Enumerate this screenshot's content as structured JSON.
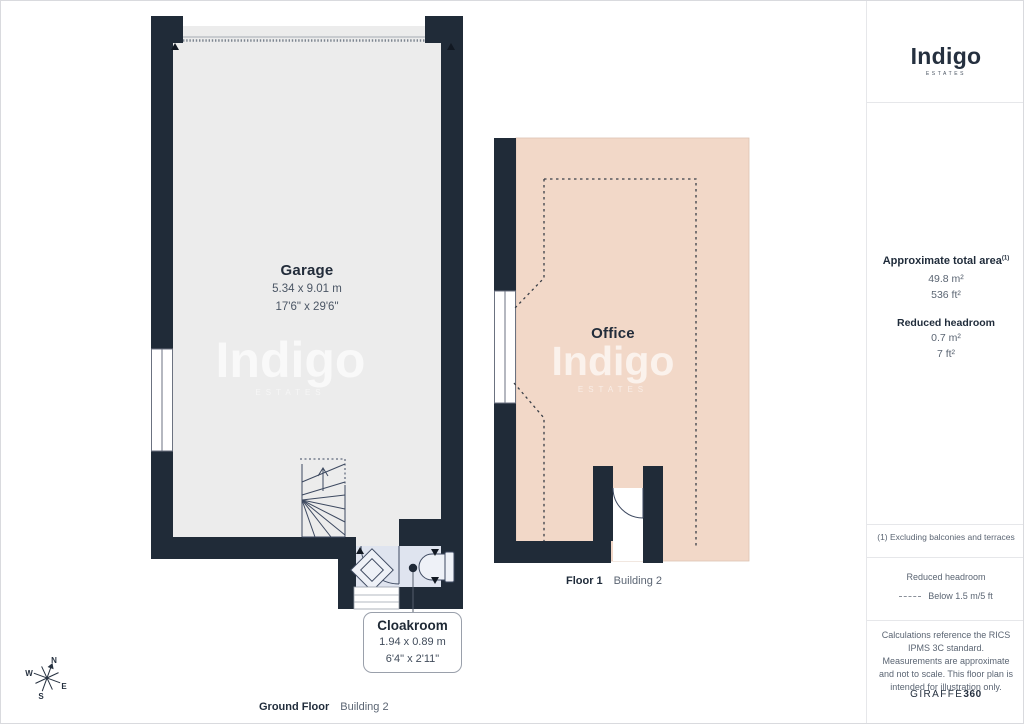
{
  "brand": {
    "logo": "Indigo",
    "logo_sub": "ESTATES"
  },
  "watermark": {
    "word": "Indigo",
    "sub": "ESTATES"
  },
  "plan": {
    "garage": {
      "name": "Garage",
      "metric": "5.34 x 9.01 m",
      "imperial": "17'6\" x 29'6\""
    },
    "office": {
      "name": "Office"
    },
    "cloakroom": {
      "name": "Cloakroom",
      "metric": "1.94 x 0.89 m",
      "imperial": "6'4\" x 2'11\""
    },
    "floor1_label": "Floor 1",
    "floor1_building": "Building 2",
    "ground_label": "Ground Floor",
    "ground_building": "Building 2",
    "compass": {
      "n": "N",
      "e": "E",
      "s": "S",
      "w": "W"
    }
  },
  "sidebar": {
    "area_title": "Approximate total area",
    "area_footnote_marker": "(1)",
    "area_m2": "49.8 m²",
    "area_ft2": "536 ft²",
    "reduced_title": "Reduced headroom",
    "reduced_m2": "0.7 m²",
    "reduced_ft2": "7 ft²",
    "footnote": "(1) Excluding balconies and terraces",
    "legend_title": "Reduced headroom",
    "legend_desc": "Below 1.5 m/5 ft",
    "disclaimer": "Calculations reference the RICS IPMS 3C standard. Measurements are approximate and not to scale. This floor plan is intended for illustration only.",
    "brand_name": "GIRAFFE",
    "brand_suffix": "360"
  },
  "colors": {
    "wall": "#202b38",
    "garage_floor": "#ececec",
    "office_floor": "#f2d8c8",
    "cloakroom_floor": "#dfe4ef",
    "text_dark": "#1f2b3a",
    "text_muted": "#5b6573"
  }
}
